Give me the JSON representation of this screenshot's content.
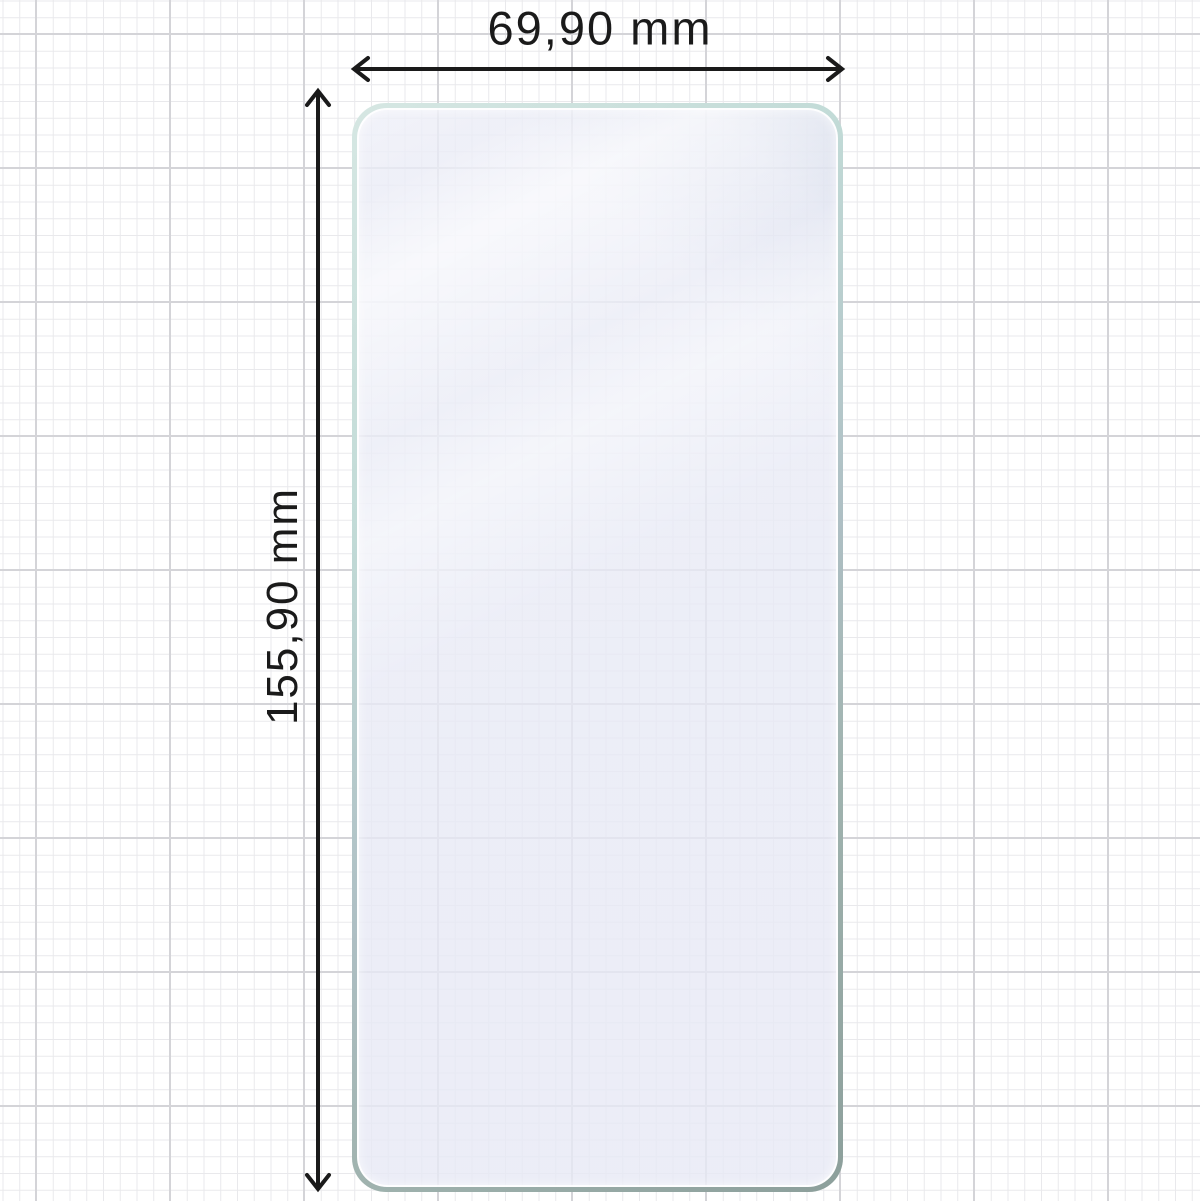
{
  "diagram": {
    "width_dimension": {
      "label": "69,90 mm"
    },
    "height_dimension": {
      "label": "155,90 mm"
    }
  },
  "icons": {
    "width_arrow": "horizontal-double-headed-arrow",
    "height_arrow": "vertical-double-headed-arrow"
  },
  "colors": {
    "background": "#ffffff",
    "grid_minor": "#e9e9ec",
    "grid_major": "#d4d4d8",
    "dimension_ink": "#1a1a1a",
    "glass_edge_light": "#d6e7e3",
    "glass_edge_dark": "#8c9f9b",
    "glass_tint": "#e7e9f5"
  }
}
